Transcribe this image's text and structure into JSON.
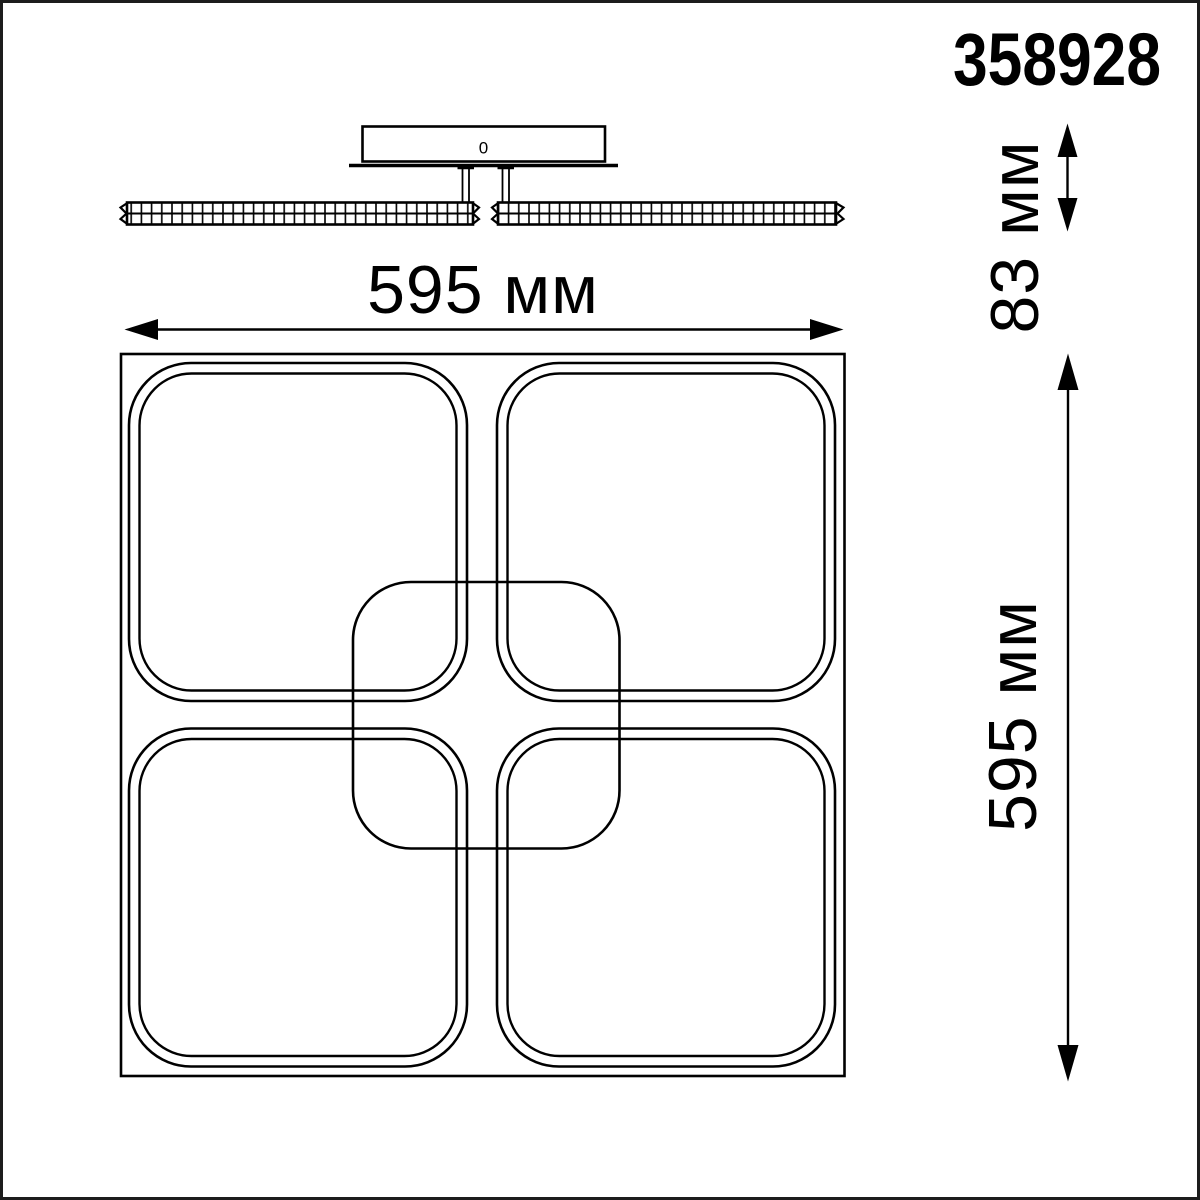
{
  "product_code": "358928",
  "labels": {
    "width": "595 мм",
    "height": "595 мм",
    "depth": "83 мм",
    "canopy_mark": "0"
  },
  "dimensions_mm": {
    "width": 595,
    "height": 595,
    "depth": 83,
    "unit": "мм"
  },
  "views": {
    "side_view": "ceiling canopy with two faceted crystal light bars",
    "top_view": "square base with four rounded-square LED modules and one central rounded-square module"
  },
  "colors": {
    "line": "#000000",
    "background": "#ffffff",
    "frame": "#1d1d1d"
  }
}
